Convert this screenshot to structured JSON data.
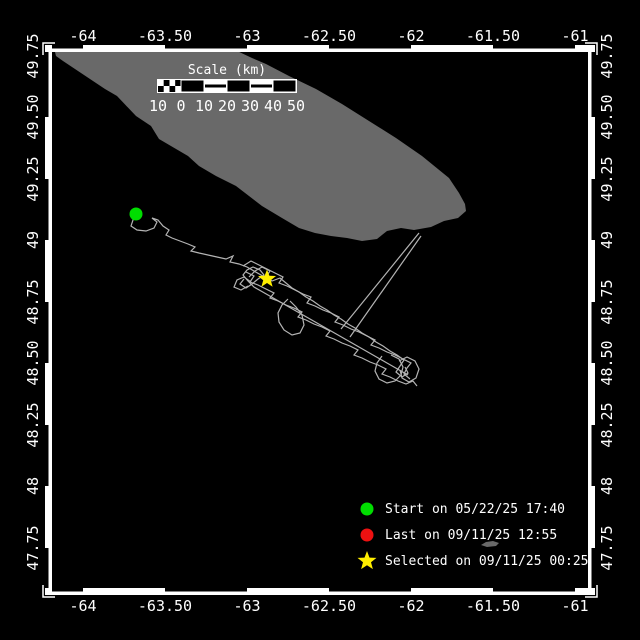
{
  "title": "Track map",
  "colors": {
    "background": "#000000",
    "land": "#696969",
    "track": "#b4b4b4",
    "frame": "#ffffff",
    "start": "#00dd00",
    "last": "#ee1111",
    "selected": "#ffee00"
  },
  "axes": {
    "lon": {
      "labels": [
        "-64",
        "-63.50",
        "-63",
        "-62.50",
        "-62",
        "-61.50",
        "-61"
      ],
      "ticks_x": [
        83,
        165,
        247,
        329,
        411,
        493,
        575
      ]
    },
    "lat": {
      "labels": [
        "49.75",
        "49.50",
        "49.25",
        "49",
        "48.75",
        "48.50",
        "48.25",
        "48",
        "47.75"
      ],
      "ticks_y": [
        56,
        117,
        179,
        240,
        302,
        363,
        425,
        486,
        548
      ]
    }
  },
  "scalebar": {
    "title": "Scale (km)",
    "labels": [
      "10",
      "0",
      "10",
      "20",
      "30",
      "40",
      "50"
    ],
    "labels_x": [
      158,
      181,
      204,
      227,
      250,
      273,
      296
    ]
  },
  "legend": {
    "items": [
      {
        "marker": "circle",
        "color": "#00dd00",
        "label": "Start on 05/22/25 17:40"
      },
      {
        "marker": "circle",
        "color": "#ee1111",
        "label": "Last on 09/11/25 12:55"
      },
      {
        "marker": "star",
        "color": "#ffee00",
        "label": "Selected on 09/11/25 00:25"
      }
    ]
  },
  "chart_data": {
    "type": "scatter",
    "title": "Animal/drifter track map",
    "xlabel": "Longitude",
    "ylabel": "Latitude",
    "xlim": [
      -64.2,
      -60.95
    ],
    "ylim": [
      47.6,
      49.78
    ],
    "start_point_lonlat": [
      -63.68,
      49.11
    ],
    "selected_point_lonlat": [
      -62.88,
      48.84
    ]
  },
  "map": {
    "island": [
      [
        55,
        52
      ],
      [
        95,
        51
      ],
      [
        135,
        50
      ],
      [
        175,
        49
      ],
      [
        212,
        48
      ],
      [
        235,
        50
      ],
      [
        252,
        58
      ],
      [
        266,
        64
      ],
      [
        289,
        76
      ],
      [
        316,
        89
      ],
      [
        342,
        104
      ],
      [
        369,
        121
      ],
      [
        396,
        138
      ],
      [
        422,
        156
      ],
      [
        449,
        178
      ],
      [
        459,
        193
      ],
      [
        465,
        204
      ],
      [
        466,
        211
      ],
      [
        458,
        218
      ],
      [
        444,
        221
      ],
      [
        431,
        227
      ],
      [
        414,
        230
      ],
      [
        401,
        228
      ],
      [
        387,
        231
      ],
      [
        377,
        239
      ],
      [
        362,
        241
      ],
      [
        347,
        238
      ],
      [
        331,
        236
      ],
      [
        315,
        233
      ],
      [
        299,
        228
      ],
      [
        282,
        218
      ],
      [
        262,
        206
      ],
      [
        249,
        196
      ],
      [
        236,
        186
      ],
      [
        216,
        176
      ],
      [
        199,
        166
      ],
      [
        188,
        156
      ],
      [
        159,
        139
      ],
      [
        151,
        126
      ],
      [
        136,
        116
      ],
      [
        117,
        96
      ],
      [
        105,
        89
      ],
      [
        81,
        73
      ],
      [
        63,
        61
      ],
      [
        56,
        56
      ]
    ],
    "islet": [
      [
        481,
        545
      ],
      [
        486,
        542
      ],
      [
        493,
        541
      ],
      [
        499,
        543
      ],
      [
        496,
        546
      ],
      [
        487,
        547
      ]
    ],
    "start_point": [
      136,
      214
    ],
    "selected_point": [
      267,
      279
    ],
    "track_polylines": [
      [
        [
          136,
          214
        ],
        [
          133,
          220
        ],
        [
          131,
          226
        ],
        [
          137,
          230
        ],
        [
          146,
          231
        ],
        [
          154,
          228
        ],
        [
          157,
          222
        ],
        [
          152,
          218
        ],
        [
          158,
          220
        ],
        [
          163,
          226
        ],
        [
          169,
          230
        ],
        [
          166,
          235
        ],
        [
          172,
          238
        ],
        [
          180,
          241
        ],
        [
          188,
          244
        ],
        [
          195,
          247
        ],
        [
          191,
          251
        ],
        [
          199,
          253
        ],
        [
          208,
          255
        ],
        [
          217,
          257
        ],
        [
          226,
          259
        ],
        [
          233,
          256
        ],
        [
          230,
          262
        ],
        [
          239,
          264
        ],
        [
          247,
          267
        ],
        [
          254,
          271
        ],
        [
          261,
          275
        ],
        [
          267,
          279
        ]
      ],
      [
        [
          243,
          266
        ],
        [
          251,
          261
        ],
        [
          259,
          265
        ],
        [
          267,
          269
        ],
        [
          275,
          273
        ],
        [
          283,
          277
        ],
        [
          279,
          283
        ],
        [
          287,
          286
        ],
        [
          295,
          290
        ],
        [
          303,
          294
        ],
        [
          311,
          297
        ],
        [
          307,
          303
        ],
        [
          315,
          306
        ],
        [
          323,
          310
        ],
        [
          331,
          313
        ],
        [
          339,
          317
        ],
        [
          335,
          322
        ],
        [
          343,
          325
        ],
        [
          351,
          329
        ],
        [
          359,
          332
        ],
        [
          367,
          336
        ],
        [
          375,
          340
        ],
        [
          371,
          345
        ],
        [
          379,
          348
        ],
        [
          387,
          352
        ],
        [
          395,
          355
        ],
        [
          403,
          359
        ],
        [
          411,
          363
        ],
        [
          407,
          368
        ],
        [
          404,
          374
        ],
        [
          410,
          379
        ]
      ],
      [
        [
          246,
          272
        ],
        [
          254,
          276
        ],
        [
          250,
          282
        ],
        [
          258,
          285
        ],
        [
          266,
          289
        ],
        [
          274,
          293
        ],
        [
          270,
          298
        ],
        [
          278,
          301
        ],
        [
          286,
          305
        ],
        [
          294,
          308
        ],
        [
          302,
          312
        ],
        [
          298,
          317
        ],
        [
          306,
          320
        ],
        [
          314,
          324
        ],
        [
          322,
          327
        ],
        [
          330,
          331
        ],
        [
          326,
          336
        ],
        [
          334,
          339
        ],
        [
          342,
          343
        ],
        [
          350,
          346
        ],
        [
          358,
          350
        ],
        [
          354,
          355
        ],
        [
          362,
          358
        ],
        [
          370,
          362
        ],
        [
          378,
          365
        ],
        [
          386,
          369
        ],
        [
          382,
          374
        ],
        [
          390,
          377
        ],
        [
          398,
          381
        ],
        [
          406,
          384
        ],
        [
          413,
          381
        ],
        [
          417,
          386
        ]
      ],
      [
        [
          249,
          277
        ],
        [
          255,
          271
        ],
        [
          262,
          267
        ],
        [
          270,
          271
        ],
        [
          266,
          277
        ],
        [
          272,
          281
        ],
        [
          280,
          278
        ],
        [
          286,
          283
        ],
        [
          292,
          288
        ],
        [
          299,
          292
        ],
        [
          306,
          297
        ],
        [
          313,
          301
        ],
        [
          320,
          306
        ],
        [
          327,
          310
        ],
        [
          334,
          315
        ],
        [
          341,
          319
        ],
        [
          348,
          324
        ],
        [
          355,
          328
        ],
        [
          362,
          333
        ],
        [
          369,
          337
        ],
        [
          376,
          342
        ],
        [
          383,
          346
        ],
        [
          390,
          351
        ],
        [
          397,
          355
        ],
        [
          404,
          360
        ],
        [
          400,
          366
        ],
        [
          396,
          372
        ],
        [
          402,
          377
        ],
        [
          408,
          373
        ],
        [
          405,
          367
        ]
      ],
      [
        [
          244,
          279
        ],
        [
          240,
          284
        ],
        [
          246,
          288
        ],
        [
          252,
          284
        ],
        [
          258,
          279
        ],
        [
          264,
          275
        ],
        [
          260,
          270
        ],
        [
          253,
          267
        ],
        [
          247,
          270
        ],
        [
          243,
          275
        ],
        [
          248,
          281
        ],
        [
          254,
          287
        ],
        [
          261,
          291
        ],
        [
          268,
          295
        ],
        [
          275,
          299
        ],
        [
          282,
          303
        ],
        [
          289,
          307
        ],
        [
          296,
          311
        ],
        [
          303,
          315
        ],
        [
          310,
          319
        ],
        [
          317,
          323
        ],
        [
          324,
          327
        ],
        [
          331,
          331
        ],
        [
          338,
          335
        ],
        [
          345,
          339
        ],
        [
          352,
          343
        ],
        [
          359,
          347
        ],
        [
          366,
          351
        ],
        [
          373,
          355
        ],
        [
          380,
          359
        ],
        [
          387,
          363
        ],
        [
          394,
          367
        ],
        [
          401,
          371
        ],
        [
          408,
          375
        ]
      ],
      [
        [
          288,
          299
        ],
        [
          282,
          305
        ],
        [
          278,
          313
        ],
        [
          279,
          322
        ],
        [
          284,
          330
        ],
        [
          292,
          335
        ],
        [
          300,
          333
        ],
        [
          304,
          325
        ],
        [
          302,
          315
        ],
        [
          296,
          307
        ],
        [
          290,
          301
        ]
      ],
      [
        [
          382,
          356
        ],
        [
          377,
          363
        ],
        [
          375,
          371
        ],
        [
          379,
          379
        ],
        [
          387,
          383
        ],
        [
          395,
          381
        ],
        [
          401,
          375
        ],
        [
          403,
          367
        ],
        [
          399,
          359
        ],
        [
          391,
          355
        ]
      ],
      [
        [
          399,
          361
        ],
        [
          407,
          357
        ],
        [
          415,
          361
        ],
        [
          419,
          369
        ],
        [
          416,
          378
        ],
        [
          409,
          382
        ],
        [
          402,
          378
        ],
        [
          400,
          370
        ]
      ],
      [
        [
          248,
          286
        ],
        [
          241,
          290
        ],
        [
          234,
          287
        ],
        [
          237,
          280
        ],
        [
          244,
          277
        ],
        [
          251,
          282
        ]
      ],
      [
        [
          341,
          329
        ],
        [
          419,
          233
        ]
      ],
      [
        [
          350,
          337
        ],
        [
          421,
          236
        ]
      ]
    ]
  }
}
